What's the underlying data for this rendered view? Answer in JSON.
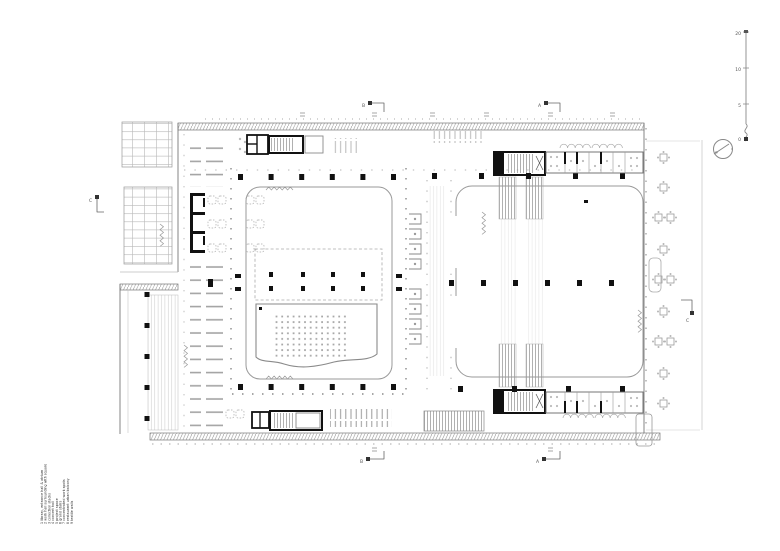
{
  "drawing": {
    "kind": "architectural floor plan",
    "background": "#ffffff"
  },
  "palette": {
    "ink": "#555555",
    "dark_walls": "#111111",
    "light_lines": "#bbbbbb",
    "faint_lines": "#d8d8d8"
  },
  "legend": {
    "items": [
      "1   library, entrance hall & atrium",
      "2   work hall surrounding with square",
      "3   collection stacks",
      "4   concert hall",
      "5   project space",
      "6   grand stairs",
      "7   concentrated work spots",
      "8   restaurant urban balcony",
      "9   textile walls"
    ]
  },
  "sections": {
    "vertical_left": "B",
    "vertical_right": "A",
    "horizontal": "C"
  },
  "scalebar": {
    "labels": [
      "20",
      "10",
      "5",
      "0"
    ]
  },
  "icons": {
    "north": "north-arrow-icon",
    "table": "table-with-chairs-icon"
  }
}
